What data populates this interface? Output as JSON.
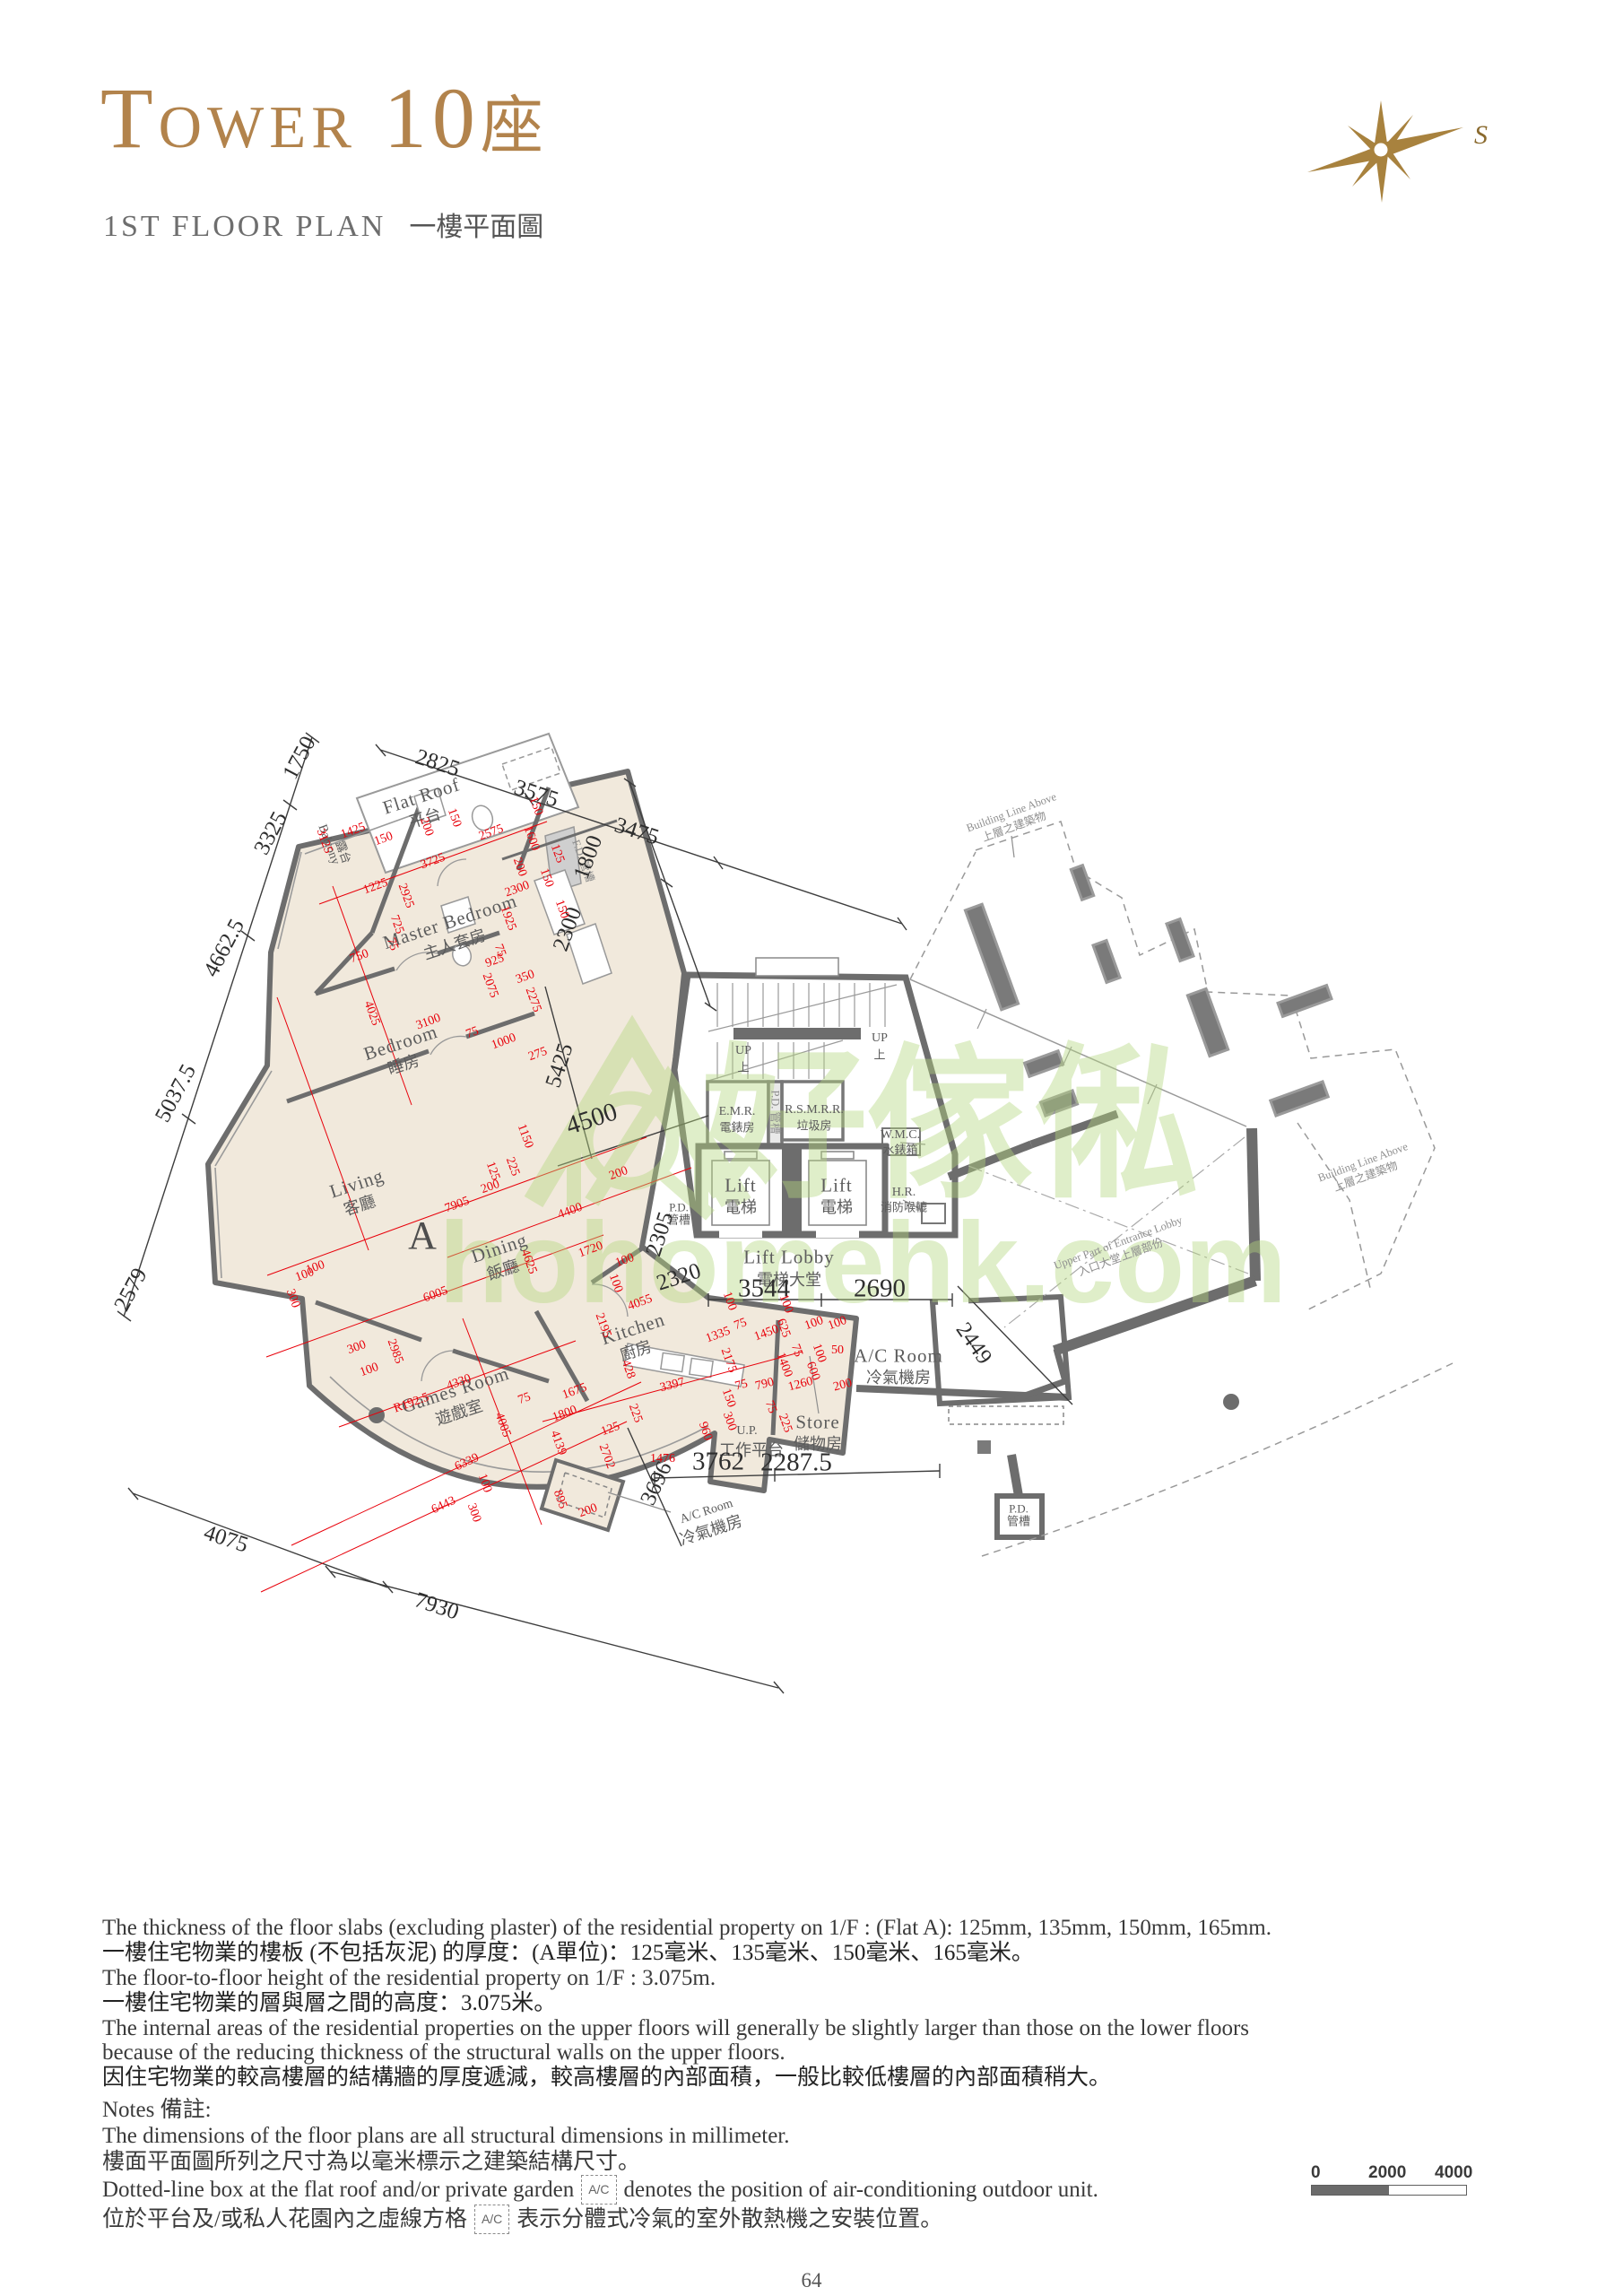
{
  "page": {
    "title_en": "Tower 10",
    "title_zh": "座",
    "subtitle_en": "1ST FLOOR PLAN",
    "subtitle_zh": "一樓平面圖",
    "compass_label": "S",
    "page_number": "64"
  },
  "colors": {
    "title_gold": "#b2834c",
    "wall_gray": "#6d6d6d",
    "unit_fill": "#f1e9dc",
    "dim_red": "#e8000a",
    "watermark_green": "#b5d77f"
  },
  "watermark": {
    "zh": "好傢俬",
    "en": "hohomehk.com"
  },
  "notes1": {
    "en1": "The thickness of the floor slabs (excluding plaster) of the residential property on 1/F : (Flat A): 125mm, 135mm, 150mm, 165mm.",
    "zh1": "一樓住宅物業的樓板 (不包括灰泥) 的厚度：(A單位)：125毫米、135毫米、150毫米、165毫米。",
    "en2": "The floor-to-floor height of the residential property on 1/F : 3.075m.",
    "zh2": "一樓住宅物業的層與層之間的高度：3.075米。",
    "en3": "The internal areas of the residential properties on the upper floors will generally be slightly larger than those on the lower floors because of the reducing thickness of the structural walls on the upper floors.",
    "zh3": "因住宅物業的較高樓層的結構牆的厚度遞減，較高樓層的內部面積，一般比較低樓層的內部面積稍大。"
  },
  "notes2": {
    "heading": "Notes 備註:",
    "l1en": "The dimensions of the floor plans are all structural dimensions in millimeter.",
    "l1zh": "樓面平面圖所列之尺寸為以毫米標示之建築結構尺寸。",
    "l2en_pre": "Dotted-line box at the flat roof and/or private garden",
    "acbox": "A/C",
    "l2en_post": "denotes the position of air-conditioning outdoor unit.",
    "l2zh_pre": "位於平台及/或私人花園內之虛線方格",
    "l2zh_post": "表示分體式冷氣的室外散熱機之安裝位置。"
  },
  "scalebar": {
    "t0": "0",
    "t1": "2000",
    "t2": "4000"
  },
  "plan": {
    "flat": "A",
    "labels": [
      [
        "Flat Roof",
        470,
        888,
        -18,
        "r"
      ],
      [
        "平台",
        474,
        912,
        -18,
        "rc"
      ],
      [
        "Balcony",
        366,
        942,
        70,
        "rs"
      ],
      [
        "露台",
        383,
        950,
        70,
        "rcs"
      ],
      [
        "Master Bedroom",
        502,
        1028,
        -18,
        "r"
      ],
      [
        "主人套房",
        507,
        1053,
        -18,
        "rc"
      ],
      [
        "Bedroom",
        447,
        1163,
        -18,
        "r"
      ],
      [
        "睡房",
        450,
        1187,
        -18,
        "rc"
      ],
      [
        "Living",
        398,
        1320,
        -18,
        "r"
      ],
      [
        "客廳",
        401,
        1344,
        -18,
        "rc"
      ],
      [
        "A",
        472,
        1378,
        0,
        "A"
      ],
      [
        "Dining",
        557,
        1392,
        -18,
        "r"
      ],
      [
        "飯廳",
        561,
        1416,
        -18,
        "rc"
      ],
      [
        "Kitchen",
        706,
        1482,
        -18,
        "r"
      ],
      [
        "廚房",
        709,
        1506,
        -18,
        "rc"
      ],
      [
        "Games Room",
        508,
        1550,
        -18,
        "r"
      ],
      [
        "遊戲室",
        512,
        1575,
        -18,
        "rc"
      ],
      [
        "E.M.R.",
        822,
        1240,
        0,
        "rs"
      ],
      [
        "電錶房",
        822,
        1257,
        0,
        "rcs"
      ],
      [
        "R.S.M.R.R.",
        908,
        1238,
        0,
        "rs"
      ],
      [
        "垃圾房",
        908,
        1255,
        0,
        "rcs"
      ],
      [
        "P.D. 管槽",
        864,
        1240,
        90,
        "g"
      ],
      [
        "W.M.C.",
        1004,
        1266,
        0,
        "rs"
      ],
      [
        "水錶箱",
        1004,
        1282,
        0,
        "rcs"
      ],
      [
        "Lift",
        826,
        1322,
        0,
        "r"
      ],
      [
        "電梯",
        826,
        1346,
        0,
        "rc"
      ],
      [
        "Lift",
        933,
        1322,
        0,
        "r"
      ],
      [
        "電梯",
        933,
        1346,
        0,
        "rc"
      ],
      [
        "H.R.",
        1008,
        1330,
        0,
        "rs"
      ],
      [
        "消防喉轆",
        1008,
        1346,
        0,
        "rcs"
      ],
      [
        "Lift Lobby",
        880,
        1402,
        0,
        "r"
      ],
      [
        "電梯大堂",
        880,
        1427,
        0,
        "rc"
      ],
      [
        "UP",
        829,
        1172,
        0,
        "rs"
      ],
      [
        "上",
        829,
        1190,
        0,
        "rcs"
      ],
      [
        "UP",
        981,
        1158,
        0,
        "rs"
      ],
      [
        "上",
        981,
        1176,
        0,
        "rcs"
      ],
      [
        "P.D.",
        757,
        1346,
        0,
        "rcs"
      ],
      [
        "管槽",
        757,
        1360,
        0,
        "rcs"
      ],
      [
        "A/C Room",
        1002,
        1512,
        0,
        "r"
      ],
      [
        "冷氣機房",
        1002,
        1536,
        0,
        "rc"
      ],
      [
        "Store",
        912,
        1586,
        0,
        "r"
      ],
      [
        "儲物房",
        912,
        1610,
        0,
        "rc"
      ],
      [
        "U.P.",
        833,
        1596,
        0,
        "rs"
      ],
      [
        "工作平台",
        838,
        1617,
        0,
        "rc"
      ],
      [
        "A/C Room",
        788,
        1686,
        -18,
        "rs"
      ],
      [
        "冷氣機房",
        793,
        1706,
        -18,
        "rc"
      ],
      [
        "F.D. 管槽",
        650,
        960,
        70,
        "g"
      ],
      [
        "P.D.",
        1136,
        1682,
        0,
        "rcs"
      ],
      [
        "管槽",
        1136,
        1696,
        0,
        "rcs"
      ],
      [
        "Building Line Above",
        1128,
        906,
        -20,
        "g"
      ],
      [
        "上層之建築物",
        1131,
        922,
        -20,
        "g"
      ],
      [
        "Building Line Above",
        1520,
        1296,
        -20,
        "g"
      ],
      [
        "上層之建築物",
        1523,
        1312,
        -20,
        "g"
      ],
      [
        "Upper Part of Entrance Lobby",
        1247,
        1386,
        -20,
        "g"
      ],
      [
        "入口大堂上層部份",
        1250,
        1402,
        -20,
        "g"
      ],
      [
        "2825",
        488,
        851,
        18,
        "d"
      ],
      [
        "3575",
        598,
        885,
        18,
        "d"
      ],
      [
        "3475",
        710,
        927,
        18,
        "d"
      ],
      [
        "1750",
        334,
        845,
        -62,
        "d"
      ],
      [
        "3325",
        302,
        929,
        -62,
        "d"
      ],
      [
        "4662.5",
        250,
        1057,
        -62,
        "d"
      ],
      [
        "5037.5",
        196,
        1219,
        -62,
        "d"
      ],
      [
        "2579",
        146,
        1438,
        -62,
        "d"
      ],
      [
        "4075",
        252,
        1716,
        18,
        "d"
      ],
      [
        "7930",
        487,
        1791,
        18,
        "d"
      ],
      [
        "1800",
        656,
        956,
        -70,
        "d"
      ],
      [
        "2300",
        633,
        1036,
        -70,
        "d"
      ],
      [
        "5425",
        624,
        1188,
        -72,
        "d"
      ],
      [
        "4500",
        660,
        1248,
        -18,
        "dl"
      ],
      [
        "2305",
        736,
        1376,
        -72,
        "d"
      ],
      [
        "2320",
        757,
        1424,
        -18,
        "d"
      ],
      [
        "3544",
        852,
        1437,
        0,
        "dl"
      ],
      [
        "2690",
        981,
        1437,
        0,
        "dl"
      ],
      [
        "2449",
        1086,
        1498,
        55,
        "d"
      ],
      [
        "3762",
        801,
        1630,
        0,
        "dl"
      ],
      [
        "2287.5",
        888,
        1631,
        0,
        "dl"
      ],
      [
        "3696",
        732,
        1654,
        -65,
        "d"
      ],
      [
        "1425",
        394,
        927,
        -20,
        "red"
      ],
      [
        "150",
        428,
        936,
        -20,
        "red"
      ],
      [
        "3125",
        361,
        938,
        70,
        "red"
      ],
      [
        "1225",
        419,
        989,
        -20,
        "red"
      ],
      [
        "3725",
        483,
        961,
        -20,
        "red"
      ],
      [
        "2925",
        452,
        999,
        70,
        "red"
      ],
      [
        "725",
        442,
        1031,
        70,
        "red"
      ],
      [
        "75",
        437,
        1053,
        70,
        "red"
      ],
      [
        "750",
        401,
        1067,
        -20,
        "red"
      ],
      [
        "4025",
        414,
        1130,
        70,
        "red"
      ],
      [
        "3100",
        478,
        1140,
        -20,
        "red"
      ],
      [
        "150",
        506,
        912,
        70,
        "red"
      ],
      [
        "200",
        475,
        922,
        70,
        "red"
      ],
      [
        "2575",
        548,
        929,
        -20,
        "red"
      ],
      [
        "1600",
        592,
        935,
        70,
        "red"
      ],
      [
        "150",
        597,
        899,
        70,
        "red"
      ],
      [
        "125",
        621,
        952,
        70,
        "red"
      ],
      [
        "200",
        579,
        967,
        70,
        "red"
      ],
      [
        "2300",
        577,
        992,
        -20,
        "red"
      ],
      [
        "150",
        609,
        979,
        70,
        "red"
      ],
      [
        "1925",
        566,
        1024,
        70,
        "red"
      ],
      [
        "150",
        626,
        1014,
        70,
        "red"
      ],
      [
        "925",
        552,
        1072,
        -20,
        "red"
      ],
      [
        "75",
        557,
        1060,
        70,
        "red"
      ],
      [
        "350",
        586,
        1090,
        -20,
        "red"
      ],
      [
        "2075",
        546,
        1099,
        70,
        "red"
      ],
      [
        "2275",
        594,
        1115,
        70,
        "red"
      ],
      [
        "75",
        527,
        1152,
        -20,
        "red"
      ],
      [
        "1000",
        562,
        1162,
        -20,
        "red"
      ],
      [
        "275",
        600,
        1176,
        -20,
        "red"
      ],
      [
        "1150",
        585,
        1267,
        70,
        "red"
      ],
      [
        "125",
        549,
        1306,
        70,
        "red"
      ],
      [
        "225",
        571,
        1301,
        70,
        "red"
      ],
      [
        "200",
        547,
        1324,
        -20,
        "red"
      ],
      [
        "7905",
        510,
        1344,
        -20,
        "red"
      ],
      [
        "4400",
        636,
        1351,
        -20,
        "red"
      ],
      [
        "200",
        690,
        1309,
        -20,
        "red"
      ],
      [
        "1720",
        659,
        1394,
        -20,
        "red"
      ],
      [
        "100",
        697,
        1406,
        -20,
        "red"
      ],
      [
        "4625",
        589,
        1407,
        70,
        "red"
      ],
      [
        "6005",
        486,
        1444,
        -20,
        "red"
      ],
      [
        "100",
        352,
        1414,
        -20,
        "red"
      ],
      [
        "100",
        340,
        1422,
        -20,
        "red"
      ],
      [
        "300",
        326,
        1448,
        70,
        "red"
      ],
      [
        "300",
        398,
        1503,
        -20,
        "red"
      ],
      [
        "2985",
        440,
        1507,
        70,
        "red"
      ],
      [
        "100",
        412,
        1528,
        -20,
        "red"
      ],
      [
        "2195",
        672,
        1478,
        70,
        "red"
      ],
      [
        "100",
        686,
        1431,
        70,
        "red"
      ],
      [
        "4055",
        714,
        1453,
        -20,
        "red"
      ],
      [
        "428",
        700,
        1527,
        70,
        "red"
      ],
      [
        "100",
        813,
        1451,
        70,
        "red"
      ],
      [
        "75",
        826,
        1477,
        -20,
        "red"
      ],
      [
        "1335",
        801,
        1489,
        -20,
        "red"
      ],
      [
        "1450",
        855,
        1487,
        -20,
        "red"
      ],
      [
        "625",
        873,
        1481,
        70,
        "red"
      ],
      [
        "100",
        876,
        1454,
        70,
        "red"
      ],
      [
        "100",
        908,
        1476,
        -20,
        "red"
      ],
      [
        "100",
        934,
        1476,
        -20,
        "red"
      ],
      [
        "2175",
        812,
        1517,
        70,
        "red"
      ],
      [
        "1400",
        874,
        1522,
        70,
        "red"
      ],
      [
        "75",
        888,
        1506,
        70,
        "red"
      ],
      [
        "600",
        906,
        1529,
        70,
        "red"
      ],
      [
        "100",
        913,
        1509,
        70,
        "red"
      ],
      [
        "50",
        934,
        1506,
        0,
        "red"
      ],
      [
        "3397",
        750,
        1545,
        -15,
        "red"
      ],
      [
        "75",
        827,
        1545,
        -15,
        "red"
      ],
      [
        "790",
        853,
        1544,
        -15,
        "red"
      ],
      [
        "1260",
        893,
        1544,
        -15,
        "red"
      ],
      [
        "200",
        940,
        1545,
        -15,
        "red"
      ],
      [
        "150",
        812,
        1559,
        70,
        "red"
      ],
      [
        "75",
        859,
        1569,
        70,
        "red"
      ],
      [
        "300",
        813,
        1585,
        70,
        "red"
      ],
      [
        "225",
        875,
        1587,
        70,
        "red"
      ],
      [
        "960",
        786,
        1596,
        70,
        "red"
      ],
      [
        "225",
        708,
        1576,
        70,
        "red"
      ],
      [
        "1476",
        739,
        1627,
        0,
        "red"
      ],
      [
        "4330",
        512,
        1542,
        -20,
        "red"
      ],
      [
        "R192.5",
        459,
        1565,
        -20,
        "red"
      ],
      [
        "75",
        585,
        1560,
        -20,
        "red"
      ],
      [
        "1675",
        641,
        1552,
        -20,
        "red"
      ],
      [
        "1800",
        630,
        1577,
        -20,
        "red"
      ],
      [
        "4005",
        560,
        1589,
        70,
        "red"
      ],
      [
        "4139",
        622,
        1609,
        70,
        "red"
      ],
      [
        "125",
        681,
        1594,
        -20,
        "red"
      ],
      [
        "2702",
        676,
        1624,
        70,
        "red"
      ],
      [
        "6339",
        521,
        1631,
        -25,
        "red"
      ],
      [
        "100",
        540,
        1654,
        70,
        "red"
      ],
      [
        "6443",
        495,
        1679,
        -25,
        "red"
      ],
      [
        "300",
        528,
        1687,
        70,
        "red"
      ],
      [
        "895",
        624,
        1672,
        70,
        "red"
      ],
      [
        "200",
        656,
        1685,
        -20,
        "red"
      ]
    ]
  }
}
